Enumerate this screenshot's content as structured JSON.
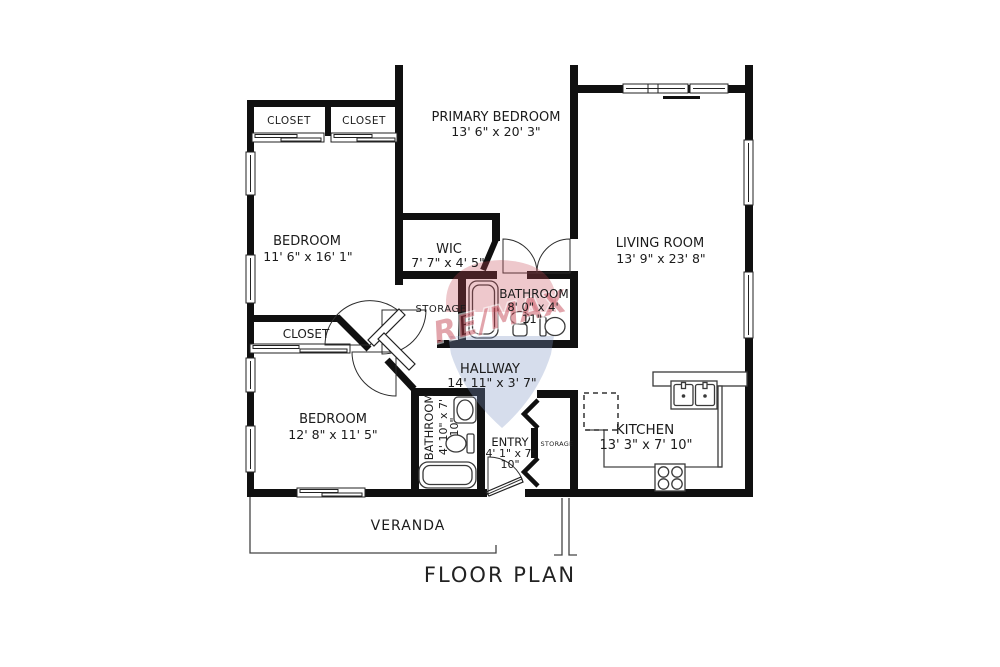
{
  "title": "FLOOR PLAN",
  "watermark": {
    "brand": "RE/MAX",
    "red": "#c64856",
    "blue": "#8094c4"
  },
  "colors": {
    "wall": "#101010",
    "text": "#1b1b1b"
  },
  "rooms": {
    "primary_bedroom": {
      "name": "PRIMARY BEDROOM",
      "dims": "13' 6\" x 20' 3\""
    },
    "bedroom_1": {
      "name": "BEDROOM",
      "dims": "11' 6\" x 16' 1\""
    },
    "bedroom_2": {
      "name": "BEDROOM",
      "dims": "12' 8\" x 11' 5\""
    },
    "living_room": {
      "name": "LIVING ROOM",
      "dims": "13' 9\" x 23' 8\""
    },
    "kitchen": {
      "name": "KITCHEN",
      "dims": "13' 3\" x 7' 10\""
    },
    "wic": {
      "name": "WIC",
      "dims": "7' 7\" x 4' 5\""
    },
    "bathroom_1": {
      "name": "BATHROOM",
      "dims_line1": "8' 0\" x 4'",
      "dims_line2": "11\""
    },
    "bathroom_2": {
      "name": "BATHROOM",
      "dims_line1": "4' 10\" x 7'",
      "dims_line2": "10\""
    },
    "hallway": {
      "name": "HALLWAY",
      "dims": "14' 11\" x 3' 7\""
    },
    "entry": {
      "name": "ENTRY",
      "dims_line1": "4' 1\" x 7'",
      "dims_line2": "10\""
    },
    "closet_top_1": {
      "name": "CLOSET"
    },
    "closet_top_2": {
      "name": "CLOSET"
    },
    "closet_bedroom2": {
      "name": "CLOSET"
    },
    "storage_hall": {
      "name": "STORAGE"
    },
    "storage_entry": {
      "name": "STORAGE"
    },
    "veranda": {
      "name": "VERANDA"
    }
  }
}
